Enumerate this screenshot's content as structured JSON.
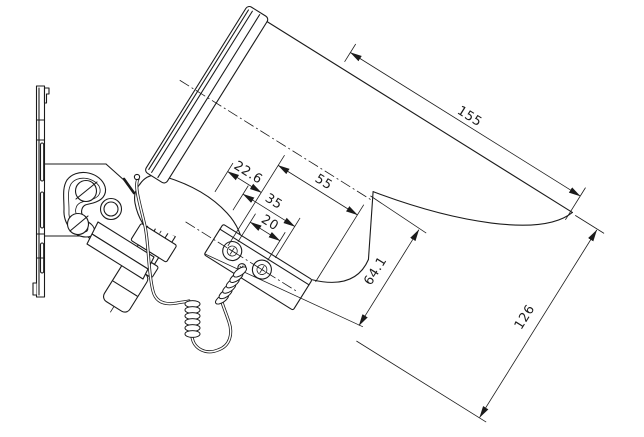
{
  "page": {
    "background": "#ffffff",
    "line_color": "#1b1b1b"
  },
  "dims": {
    "d155": "155",
    "d126": "126",
    "d641": "64.1",
    "d55": "55",
    "d35": "35",
    "d20": "20",
    "d226": "22.6"
  }
}
